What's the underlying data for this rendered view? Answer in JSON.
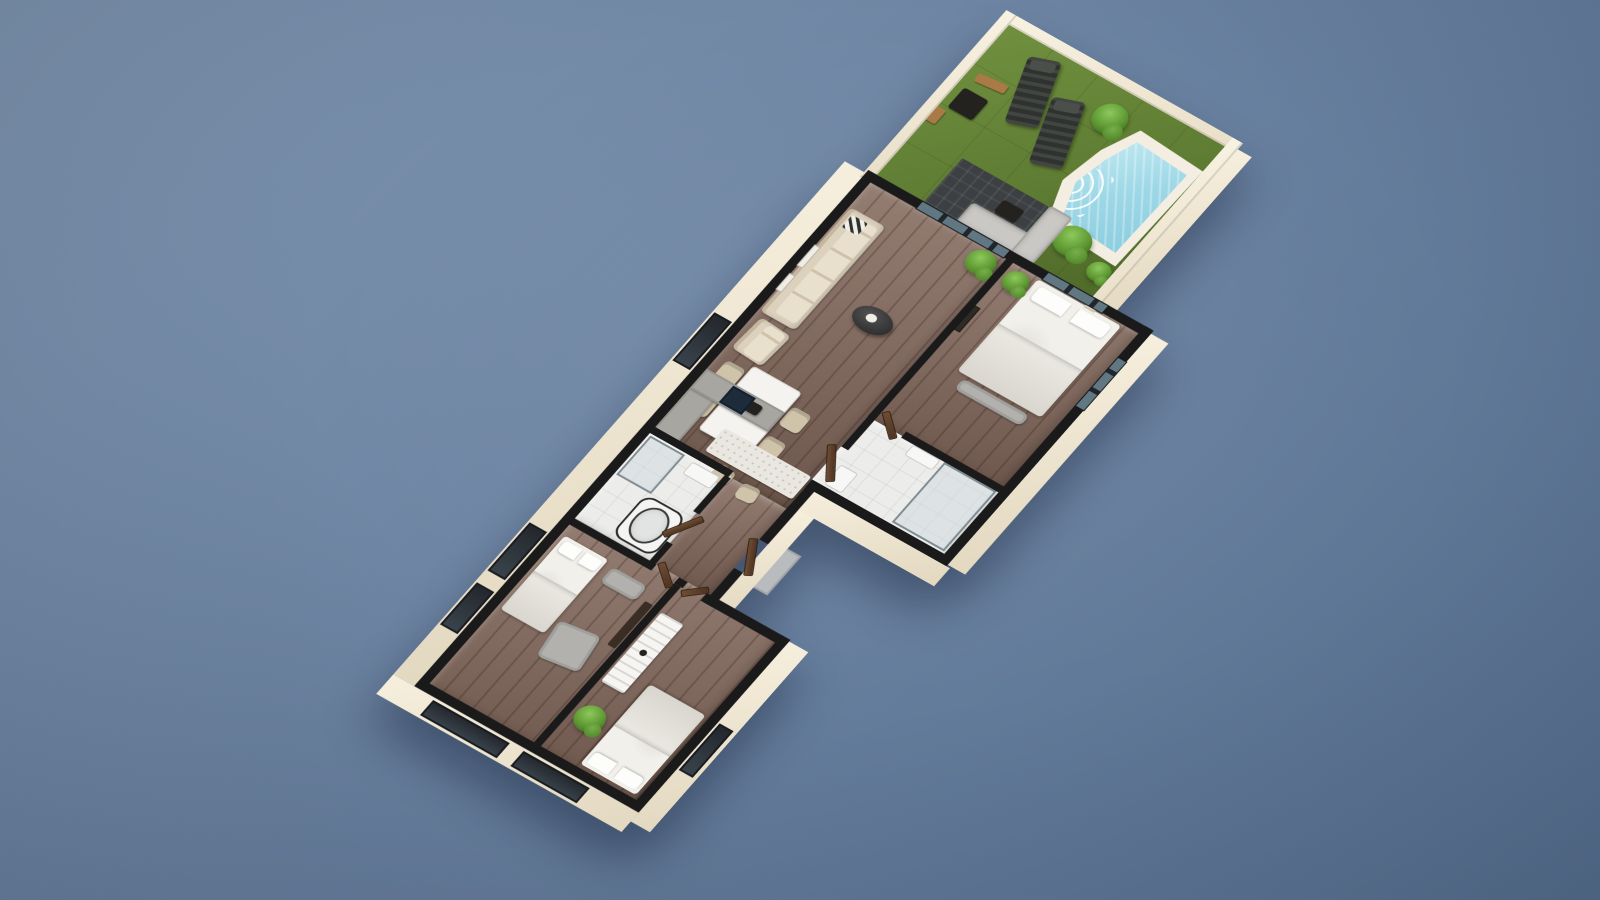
{
  "meta": {
    "description": "3D isometric floor plan rendering of a single-storey apartment with walled garden, swimming pool, open living-dining-kitchen area, master bedroom with ensuite, bathroom, hallway and two further bedrooms",
    "canvas": {
      "width": 1600,
      "height": 900
    }
  },
  "theme": {
    "bg1": "#8096b0",
    "bg2": "#6a82a1",
    "bg3": "#57708f",
    "grass1": "#66853a",
    "water": "#a7dcea",
    "deck": "#f3eee1",
    "wallcut": "#1a1a1a",
    "facade1": "#f6efdd",
    "facade2": "#e3d8c0",
    "wood1": "#82675a",
    "tile": "#ececea",
    "cream": "#dcd1bd",
    "gray1": "#c9c8c4",
    "woodlite": "#a97a45",
    "plant1": "#8cc95b",
    "plant2": "#5d9631",
    "navy": "#1d2b3a"
  },
  "scene": {
    "origin": {
      "x": 60,
      "y": 230
    },
    "transform": {
      "a": 0.87,
      "b": 0.49,
      "c": -0.66,
      "d": 0.75,
      "tx": 969.6,
      "ty": -21.9
    },
    "items": [
      {
        "n": "garden-grass",
        "c": "grass",
        "x": 0,
        "y": -210,
        "w": 250,
        "h": 210,
        "z": 1
      },
      {
        "n": "pool-deck",
        "c": "pool-deck",
        "x": 148,
        "y": -180,
        "w": 102,
        "h": 134,
        "z": 2
      },
      {
        "n": "pool-water",
        "c": "pool-water",
        "x": 158,
        "y": -170,
        "w": 84,
        "h": 114,
        "z": 3
      },
      {
        "n": "sun-lounger-1",
        "c": "lounger",
        "x": 50,
        "y": -198,
        "w": 32,
        "h": 76,
        "r": -20,
        "z": 3
      },
      {
        "n": "sun-lounger-2",
        "c": "lounger",
        "x": 96,
        "y": -174,
        "w": 32,
        "h": 76,
        "r": -20,
        "z": 3
      },
      {
        "n": "garden-side-table",
        "c": "table-dark",
        "x": 10,
        "y": -130,
        "w": 28,
        "h": 26,
        "z": 3
      },
      {
        "n": "garden-bench",
        "c": "bench-wood",
        "x": 12,
        "y": -152,
        "w": 32,
        "h": 10,
        "r": -6,
        "z": 3
      },
      {
        "n": "garden-stool",
        "c": "bench-wood",
        "x": 0,
        "y": -100,
        "w": 12,
        "h": 18,
        "z": 3
      },
      {
        "n": "garden-bush-1",
        "c": "plant",
        "x": 126,
        "y": -192,
        "w": 34,
        "h": 34,
        "z": 3
      },
      {
        "n": "garden-bush-2",
        "c": "plant",
        "x": 178,
        "y": -64,
        "w": 38,
        "h": 34,
        "z": 3
      },
      {
        "n": "garden-bush-3",
        "c": "plant",
        "x": 226,
        "y": -44,
        "w": 24,
        "h": 22,
        "z": 3
      },
      {
        "n": "outdoor-rug",
        "c": "rug-dark",
        "x": 56,
        "y": -66,
        "w": 100,
        "h": 58,
        "z": 2
      },
      {
        "n": "outdoor-sofa-long",
        "c": "sofa-gray",
        "x": 94,
        "y": -32,
        "w": 88,
        "h": 26,
        "z": 3
      },
      {
        "n": "outdoor-sofa-chaise",
        "c": "sofa-gray",
        "x": 156,
        "y": -68,
        "w": 26,
        "h": 62,
        "z": 3
      },
      {
        "n": "outdoor-coffee-table",
        "c": "table-dark",
        "x": 116,
        "y": -50,
        "w": 24,
        "h": 16,
        "z": 3
      },
      {
        "n": "garden-wall-top",
        "c": "fac-wall",
        "x": -10,
        "y": -220,
        "w": 272,
        "h": 12,
        "z": 4
      },
      {
        "n": "garden-wall-left",
        "c": "fac-wall",
        "x": -10,
        "y": -220,
        "w": 12,
        "h": 222,
        "z": 4
      },
      {
        "n": "garden-wall-right",
        "c": "fac-wall",
        "x": 250,
        "y": -220,
        "w": 12,
        "h": 226,
        "z": 4
      },
      {
        "n": "garden-facade-right",
        "c": "fac",
        "x": 262,
        "y": -212,
        "w": 16,
        "h": 222,
        "z": 0
      },
      {
        "n": "floor-living-room",
        "c": "floor-wood",
        "x": 0,
        "y": 0,
        "w": 158,
        "h": 335,
        "z": 1
      },
      {
        "n": "floor-master-bedroom",
        "c": "floor-wood",
        "x": 158,
        "y": 0,
        "w": 152,
        "h": 212,
        "z": 1
      },
      {
        "n": "floor-ensuite",
        "c": "floor-tile",
        "x": 158,
        "y": 212,
        "w": 152,
        "h": 92,
        "z": 1
      },
      {
        "n": "floor-bathroom",
        "c": "floor-tile",
        "x": 0,
        "y": 335,
        "w": 92,
        "h": 115,
        "z": 1
      },
      {
        "n": "floor-hallway",
        "c": "floor-wood",
        "x": 92,
        "y": 335,
        "w": 66,
        "h": 120,
        "z": 1
      },
      {
        "n": "floor-bedrooms",
        "c": "floor-wood",
        "x": 0,
        "y": 450,
        "w": 240,
        "h": 224,
        "z": 1
      },
      {
        "n": "sliding-glass-door",
        "c": "glass",
        "x": 55,
        "y": -7,
        "w": 100,
        "h": 9,
        "z": 5
      },
      {
        "n": "sofa",
        "c": "sofa-cream",
        "x": 4,
        "y": 34,
        "w": 40,
        "h": 138,
        "z": 3
      },
      {
        "n": "sofa-pillow-chevron",
        "c": "chevron",
        "x": 10,
        "y": 40,
        "w": 18,
        "h": 16,
        "z": 4
      },
      {
        "n": "armchair",
        "c": "sofa-cream",
        "x": 8,
        "y": 178,
        "w": 36,
        "h": 42,
        "r": 4,
        "z": 3
      },
      {
        "n": "coffee-table",
        "c": "table-oval",
        "x": 76,
        "y": 110,
        "w": 42,
        "h": 28,
        "z": 3
      },
      {
        "n": "living-plant",
        "c": "plant",
        "x": 126,
        "y": 4,
        "w": 30,
        "h": 28,
        "z": 3
      },
      {
        "n": "dining-chair-1",
        "c": "chair-beige",
        "x": 12,
        "y": 232,
        "w": 22,
        "h": 24,
        "z": 2
      },
      {
        "n": "dining-chair-2",
        "c": "chair-beige",
        "x": 12,
        "y": 272,
        "w": 22,
        "h": 24,
        "z": 2
      },
      {
        "n": "dining-chair-3",
        "c": "chair-beige",
        "x": 94,
        "y": 240,
        "w": 22,
        "h": 24,
        "z": 2
      },
      {
        "n": "dining-chair-4",
        "c": "chair-beige",
        "x": 94,
        "y": 278,
        "w": 22,
        "h": 24,
        "z": 2
      },
      {
        "n": "dining-table",
        "c": "table-white",
        "x": 36,
        "y": 224,
        "w": 56,
        "h": 84,
        "z": 3
      },
      {
        "n": "dining-table-decor",
        "c": "table-dark",
        "x": 52,
        "y": 256,
        "w": 20,
        "h": 12,
        "z": 4
      },
      {
        "n": "wall-art-1",
        "c": "frame-light",
        "x": 2,
        "y": 86,
        "w": 5,
        "h": 26,
        "z": 5
      },
      {
        "n": "wall-art-2",
        "c": "frame-light",
        "x": 2,
        "y": 124,
        "w": 5,
        "h": 20,
        "z": 5
      },
      {
        "n": "kitchen-counter-left",
        "c": "counter-gray",
        "x": 2,
        "y": 250,
        "w": 28,
        "h": 82,
        "z": 3
      },
      {
        "n": "kitchen-counter-top",
        "c": "counter-gray",
        "x": 2,
        "y": 250,
        "w": 90,
        "h": 26,
        "z": 3
      },
      {
        "n": "kitchen-stove",
        "c": "appliance-navy",
        "x": 34,
        "y": 252,
        "w": 26,
        "h": 22,
        "z": 4
      },
      {
        "n": "kitchen-island",
        "c": "island-white",
        "x": 56,
        "y": 294,
        "w": 100,
        "h": 30,
        "z": 3
      },
      {
        "n": "bar-stool-1",
        "c": "chair-beige",
        "x": 76,
        "y": 328,
        "w": 20,
        "h": 18,
        "r": 8,
        "z": 3
      },
      {
        "n": "bar-stool-2",
        "c": "chair-beige",
        "x": 108,
        "y": 332,
        "w": 20,
        "h": 18,
        "r": -6,
        "z": 3
      },
      {
        "n": "master-bed",
        "c": "bed",
        "x": 196,
        "y": 4,
        "w": 96,
        "h": 122,
        "z": 3
      },
      {
        "n": "master-bed-bench",
        "c": "sofa-gray2",
        "x": 206,
        "y": 130,
        "w": 76,
        "h": 14,
        "z": 3
      },
      {
        "n": "master-plant",
        "c": "plant",
        "x": 168,
        "y": 6,
        "w": 26,
        "h": 24,
        "z": 3
      },
      {
        "n": "master-wall-art",
        "c": "frame-dark",
        "x": 166,
        "y": 60,
        "w": 5,
        "h": 30,
        "z": 5
      },
      {
        "n": "master-window",
        "c": "glass",
        "x": 200,
        "y": -7,
        "w": 68,
        "h": 9,
        "z": 5
      },
      {
        "n": "master-window-side",
        "c": "glass-v",
        "x": 311,
        "y": 34,
        "w": 9,
        "h": 64,
        "z": 5
      },
      {
        "n": "ensuite-shower",
        "c": "glass-panel",
        "x": 248,
        "y": 214,
        "w": 60,
        "h": 80,
        "z": 3
      },
      {
        "n": "ensuite-toilet",
        "c": "white-obj",
        "x": 170,
        "y": 268,
        "w": 20,
        "h": 26,
        "z": 3
      },
      {
        "n": "ensuite-sink",
        "c": "white-obj",
        "x": 212,
        "y": 214,
        "w": 32,
        "h": 14,
        "z": 3
      },
      {
        "n": "door-ensuite",
        "c": "door",
        "x": 166,
        "y": 206,
        "w": 30,
        "h": 6,
        "r": 40,
        "z": 5
      },
      {
        "n": "bathroom-shower",
        "c": "glass-panel",
        "x": 4,
        "y": 338,
        "w": 40,
        "h": 52,
        "z": 3
      },
      {
        "n": "bathtub",
        "c": "tub",
        "x": 40,
        "y": 392,
        "w": 48,
        "h": 54,
        "z": 3
      },
      {
        "n": "bathroom-sink",
        "c": "white-obj",
        "x": 54,
        "y": 340,
        "w": 32,
        "h": 16,
        "z": 3
      },
      {
        "n": "door-bathroom",
        "c": "door",
        "x": 88,
        "y": 384,
        "w": 6,
        "h": 38,
        "r": 30,
        "z": 5
      },
      {
        "n": "door-master-hall",
        "c": "door",
        "x": 158,
        "y": 252,
        "w": 7,
        "h": 40,
        "r": -35,
        "z": 5
      },
      {
        "n": "door-entrance",
        "c": "door",
        "x": 160,
        "y": 376,
        "w": 7,
        "h": 40,
        "r": -30,
        "z": 5
      },
      {
        "n": "entry-porch",
        "c": "porch",
        "x": 168,
        "y": 370,
        "w": 34,
        "h": 52,
        "z": 0
      },
      {
        "n": "bedroom2-bed",
        "c": "bed",
        "x": 6,
        "y": 470,
        "w": 50,
        "h": 98,
        "z": 3
      },
      {
        "n": "bedroom2-armchair",
        "c": "sofa-gray2",
        "x": 62,
        "y": 545,
        "w": 44,
        "h": 44,
        "r": -8,
        "z": 3
      },
      {
        "n": "bedroom2-bench",
        "c": "sofa-gray2",
        "x": 64,
        "y": 474,
        "w": 40,
        "h": 20,
        "z": 3
      },
      {
        "n": "bedroom2-tv-unit",
        "c": "dark-wood",
        "x": 112,
        "y": 488,
        "w": 9,
        "h": 58,
        "z": 3
      },
      {
        "n": "door-bedroom-2",
        "c": "door",
        "x": 96,
        "y": 452,
        "w": 28,
        "h": 6,
        "r": 38,
        "z": 5
      },
      {
        "n": "bedroom3-dresser",
        "c": "dresser",
        "x": 132,
        "y": 490,
        "w": 26,
        "h": 92,
        "z": 3
      },
      {
        "n": "bedroom3-bed",
        "c": "bed",
        "x": 172,
        "y": 560,
        "w": 64,
        "h": 106,
        "r": 180,
        "z": 3
      },
      {
        "n": "bedroom3-plant",
        "c": "plant",
        "x": 134,
        "y": 606,
        "w": 30,
        "h": 30,
        "z": 3
      },
      {
        "n": "door-bedroom-3",
        "c": "door",
        "x": 132,
        "y": 452,
        "w": 24,
        "h": 6,
        "r": -42,
        "z": 5
      },
      {
        "n": "wall-top",
        "c": "wall",
        "x": -8,
        "y": -8,
        "w": 326,
        "h": 10,
        "z": 4
      },
      {
        "n": "wall-left",
        "c": "wall",
        "x": -8,
        "y": -8,
        "w": 10,
        "h": 686,
        "z": 4
      },
      {
        "n": "wall-right-master",
        "c": "wall",
        "x": 310,
        "y": -8,
        "w": 10,
        "h": 312,
        "z": 4
      },
      {
        "n": "wall-ensuite-bottom",
        "c": "wall",
        "x": 158,
        "y": 296,
        "w": 162,
        "h": 10,
        "z": 4
      },
      {
        "n": "wall-hall-right-upper",
        "c": "wall",
        "x": 158,
        "y": 296,
        "w": 10,
        "h": 80,
        "z": 4
      },
      {
        "n": "wall-hall-right-lower",
        "c": "wall",
        "x": 158,
        "y": 414,
        "w": 10,
        "h": 46,
        "z": 4
      },
      {
        "n": "wall-living-master-divider",
        "c": "wall",
        "x": 158,
        "y": 0,
        "w": 8,
        "h": 252,
        "z": 4
      },
      {
        "n": "wall-master-ensuite-divider",
        "c": "wall",
        "x": 198,
        "y": 206,
        "w": 112,
        "h": 8,
        "z": 4
      },
      {
        "n": "wall-kitchen-bath-divider",
        "c": "wall",
        "x": 0,
        "y": 328,
        "w": 92,
        "h": 8,
        "z": 4
      },
      {
        "n": "wall-bath-hall-upper",
        "c": "wall",
        "x": 88,
        "y": 336,
        "w": 7,
        "h": 48,
        "z": 4
      },
      {
        "n": "wall-bath-hall-lower",
        "c": "wall",
        "x": 88,
        "y": 424,
        "w": 7,
        "h": 30,
        "z": 4
      },
      {
        "n": "wall-block-top-left",
        "c": "wall",
        "x": 0,
        "y": 450,
        "w": 96,
        "h": 8,
        "z": 4
      },
      {
        "n": "wall-block-top-stub",
        "c": "wall",
        "x": 122,
        "y": 450,
        "w": 10,
        "h": 8,
        "z": 4
      },
      {
        "n": "wall-block-step",
        "c": "wall",
        "x": 154,
        "y": 450,
        "w": 96,
        "h": 10,
        "z": 4
      },
      {
        "n": "wall-bed-divider",
        "c": "wall",
        "x": 122,
        "y": 458,
        "w": 8,
        "h": 220,
        "z": 4
      },
      {
        "n": "wall-right-block",
        "c": "wall",
        "x": 240,
        "y": 450,
        "w": 10,
        "h": 230,
        "z": 4
      },
      {
        "n": "wall-bottom",
        "c": "wall",
        "x": -8,
        "y": 670,
        "w": 258,
        "h": 10,
        "z": 4
      },
      {
        "n": "facade-left",
        "c": "fac",
        "x": -32,
        "y": -4,
        "w": 24,
        "h": 684,
        "z": 0
      },
      {
        "n": "facade-left-window-1",
        "c": "win-dark",
        "x": -30,
        "y": 196,
        "w": 20,
        "h": 64,
        "z": 1
      },
      {
        "n": "facade-left-window-2",
        "c": "win-dark",
        "x": -30,
        "y": 476,
        "w": 20,
        "h": 64,
        "z": 1
      },
      {
        "n": "facade-left-window-3",
        "c": "win-dark",
        "x": -30,
        "y": 556,
        "w": 20,
        "h": 56,
        "z": 1
      },
      {
        "n": "facade-bottom",
        "c": "fac",
        "x": -32,
        "y": 680,
        "w": 282,
        "h": 26,
        "z": 0
      },
      {
        "n": "facade-bottom-window-1",
        "c": "win-dark",
        "x": 16,
        "y": 683,
        "w": 88,
        "h": 20,
        "z": 1
      },
      {
        "n": "facade-bottom-window-2",
        "c": "win-dark",
        "x": 120,
        "y": 683,
        "w": 76,
        "h": 20,
        "z": 1
      },
      {
        "n": "facade-right-master",
        "c": "fac",
        "x": 320,
        "y": -4,
        "w": 20,
        "h": 308,
        "z": 0
      },
      {
        "n": "facade-ensuite",
        "c": "fac",
        "x": 158,
        "y": 306,
        "w": 166,
        "h": 24,
        "z": 0
      },
      {
        "n": "facade-hall-right",
        "c": "fac",
        "x": 168,
        "y": 330,
        "w": 18,
        "h": 138,
        "z": 0
      },
      {
        "n": "facade-right-block",
        "c": "fac",
        "x": 250,
        "y": 452,
        "w": 22,
        "h": 240,
        "z": 0
      },
      {
        "n": "facade-right-block-window",
        "c": "win-dark",
        "x": 252,
        "y": 560,
        "w": 16,
        "h": 62,
        "z": 1
      }
    ]
  }
}
